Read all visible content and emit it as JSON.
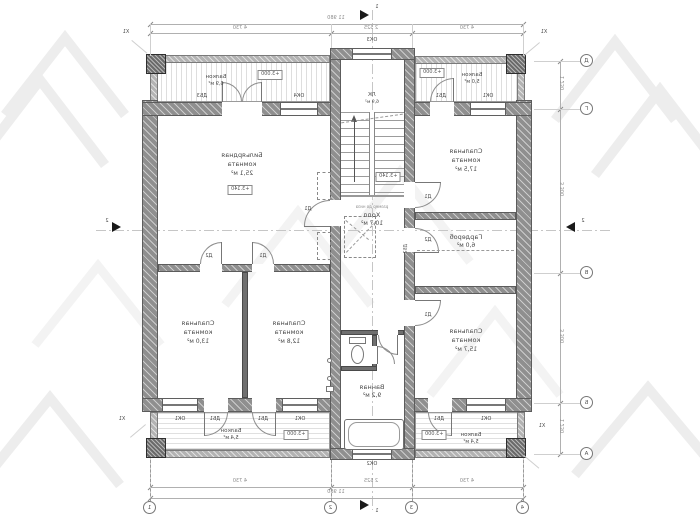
{
  "rooms": {
    "billiard": {
      "name": "Бильярдная",
      "name2": "комната",
      "area": "25,1 м²"
    },
    "bedroom_tr": {
      "name": "Спальная",
      "name2": "комната",
      "area": "17,5 м²"
    },
    "wardrobe": {
      "name": "Гардероб",
      "area": "6,0 м²"
    },
    "bedroom_br": {
      "name": "Спальная",
      "name2": "комната",
      "area": "15,7 м²"
    },
    "bedroom_bl1": {
      "name": "Спальная",
      "name2": "комната",
      "area": "13,0 м²"
    },
    "bedroom_bl2": {
      "name": "Спальная",
      "name2": "комната",
      "area": "12,8 м²"
    },
    "hall": {
      "name": "Холл",
      "area": "10,7 м²",
      "note": "размер до низа"
    },
    "bath": {
      "name": "Ванная",
      "area": "9,2 м²"
    },
    "stair": {
      "name": "ЛК",
      "area": "6,9 м²"
    }
  },
  "balconies": {
    "tl": {
      "name": "Балкон",
      "area": "6,9 м²"
    },
    "tr": {
      "name": "Балкон",
      "area": "5,0 м²"
    },
    "bl": {
      "name": "Балкон",
      "area": "5,4 м²"
    },
    "br": {
      "name": "Балкон",
      "area": "5,4 м²"
    }
  },
  "levels": {
    "interior": "+3.140",
    "balcony": "+3.000"
  },
  "openings": {
    "ok1": "ОК1",
    "ok2": "ОК2",
    "ok3": "ОК3",
    "ok4": "ОК4",
    "db1": "ДБ1",
    "db2": "ДБ2",
    "db3": "ДБ3",
    "d1": "Д1",
    "d2": "Д2"
  },
  "grid": {
    "bottom": [
      "1",
      "2",
      "3",
      "4"
    ],
    "right": [
      "Д",
      "Г",
      "В",
      "Б",
      "А"
    ],
    "corner_label": "X1"
  },
  "dims": {
    "top_total": "11 980",
    "top_segments": [
      "4 730",
      "2 525",
      "4 730"
    ],
    "bottom_segments": [
      "4 730",
      "2 525",
      "4 730"
    ],
    "bottom_total": "11 980",
    "right_segments": [
      "1 230",
      "3 300",
      "3 300",
      "1 230"
    ]
  },
  "sections": {
    "vertical": "1",
    "horizontal": "2"
  }
}
